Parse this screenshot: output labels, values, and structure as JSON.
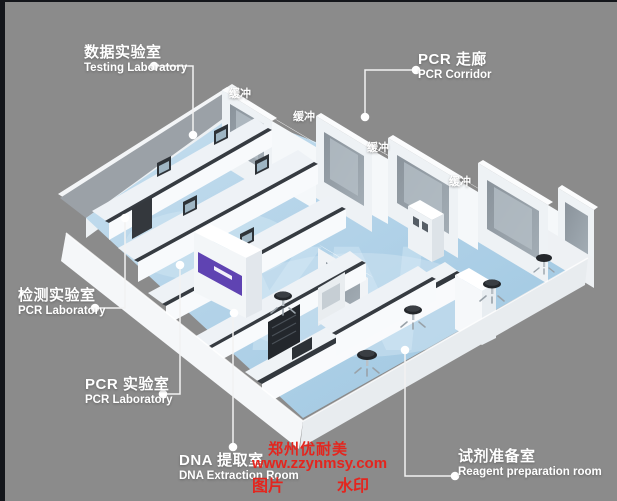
{
  "scene": {
    "description": "3D isometric rendering of a PCR laboratory suite floor plan",
    "background_color": "#8b8b8b",
    "frame_color": "#14161b",
    "floor_color": "#aecfe6",
    "wall_color": "#f0f3f6",
    "window_color": "#8a939b",
    "accent_purple": "#5f43b2",
    "countertop_color": "#363b41",
    "floor_watermark_letters": "YN"
  },
  "labels": {
    "testing_lab": {
      "zh": "数据实验室",
      "en": "Testing Laboratory"
    },
    "pcr_corridor": {
      "zh": "PCR 走廊",
      "en": "PCR Corridor"
    },
    "pcr_lab_left": {
      "zh": "检测实验室",
      "en": "PCR Laboratory"
    },
    "pcr_lab_bottom": {
      "zh": "PCR 实验室",
      "en": "PCR Laboratory"
    },
    "dna_room": {
      "zh": "DNA 提取室",
      "en": "DNA Extraction Room"
    },
    "reagent_room": {
      "zh": "试剂准备室",
      "en": "Reagent preparation room"
    }
  },
  "buffer_labels": [
    "缓冲",
    "缓冲",
    "缓冲",
    "缓冲"
  ],
  "watermark": {
    "color": "#e4251e",
    "company": "郑州优耐美",
    "url": "www.zzynmsy.com",
    "tag_left": "图片",
    "tag_right": "水印"
  }
}
